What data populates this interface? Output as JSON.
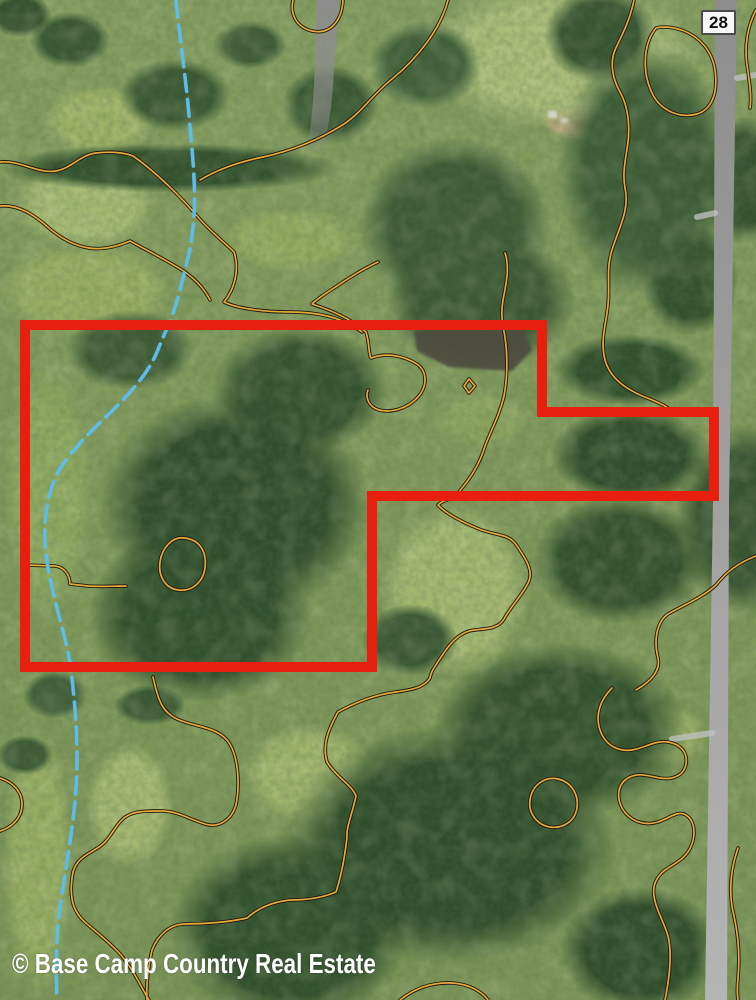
{
  "map": {
    "kind": "aerial-property-map",
    "road_shield": {
      "label": "28"
    },
    "watermark": {
      "text": "© Base Camp Country Real Estate"
    },
    "boundary": {
      "points": "25,325 542,325 542,412 714,412 714,496 372,496 372,667 25,667",
      "stroke_width": 10
    },
    "features": {
      "stream": "dashed blue creek running north-south on west side",
      "contours": "orange soil/terrain boundary lines with dark casing",
      "road": "gray highway along east edge, route 28"
    },
    "colors": {
      "boundary": "#e81e0e",
      "stream": "#5ebce6",
      "contour": "#e8a93c",
      "contour_casing": "#1d1a10",
      "road": "#9b9b9b",
      "shield_bg": "#f7f7f7",
      "shield_border": "#4a4a4a",
      "shield_text": "#111111",
      "watermark_text": "#ffffff"
    }
  }
}
